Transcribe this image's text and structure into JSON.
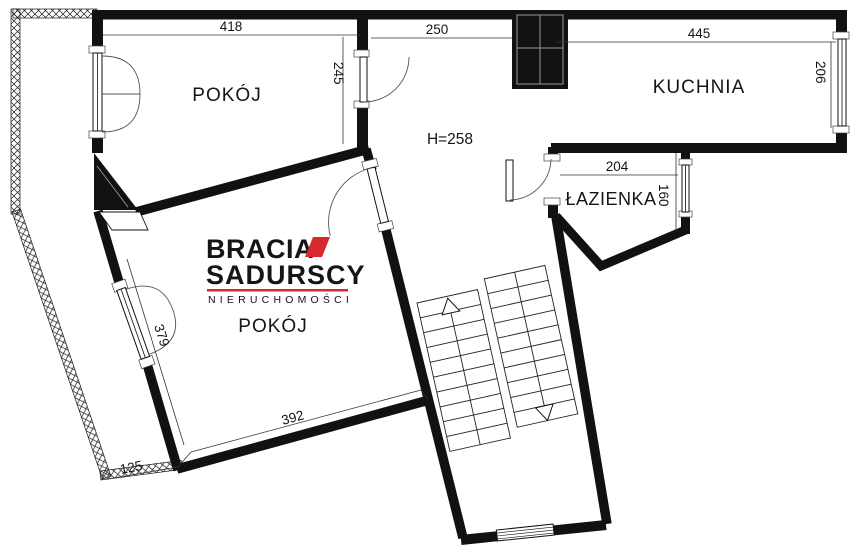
{
  "plan": {
    "rooms": {
      "room_top": "POKÓJ",
      "kitchen": "KUCHNIA",
      "bathroom": "ŁAZIENKA",
      "room_bottom": "POKÓJ"
    },
    "height_note": "H=258",
    "dimensions": {
      "top_room_width": "418",
      "hall_width": "250",
      "kitchen_width": "445",
      "top_room_depth": "245",
      "kitchen_depth": "206",
      "bathroom_width": "204",
      "bathroom_depth": "160",
      "bottom_room_side": "379",
      "bottom_room_width": "392",
      "edge_bottom_left": "125"
    }
  },
  "logo": {
    "line1": "BRACIA",
    "line2": "SADURSCY",
    "tagline": "NIERUCHOMOŚCI"
  },
  "colors": {
    "accent_red": "#d7282f",
    "ink": "#26262b",
    "wall": "#111111"
  }
}
